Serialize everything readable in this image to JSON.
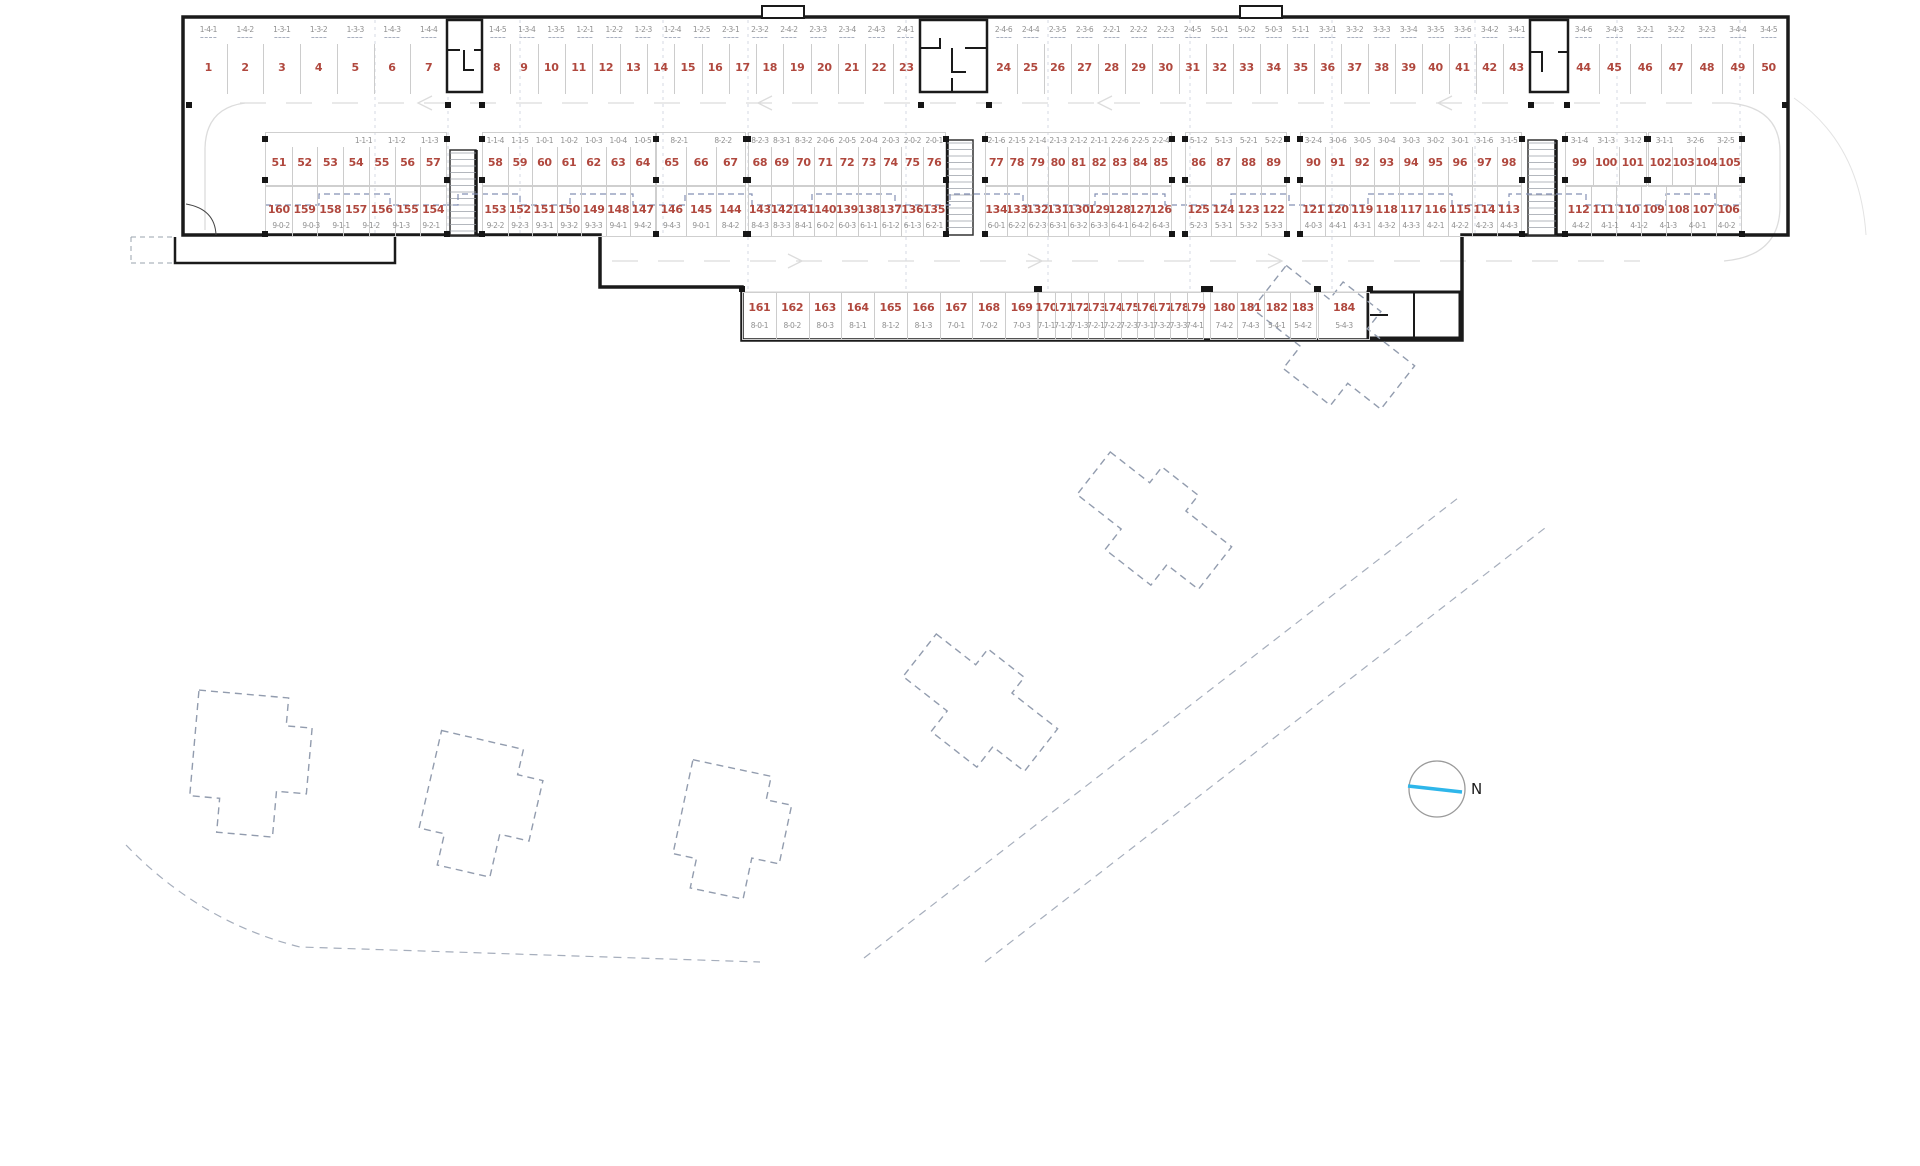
{
  "plan": {
    "type": "parking-garage-floor-plan",
    "north_label": "N",
    "colors": {
      "space_number": "#b0483e",
      "unit_code": "#8f8f8f",
      "wall": "#1a1a1a",
      "dashed_outline": "#929cae",
      "partition_dash": "#8490b4",
      "aisle_marking": "#dcdcdc",
      "north_arrow": "#2eb6ea"
    },
    "rows": [
      {
        "name": "row-1-top",
        "codes_position": "above",
        "groups": [
          {
            "numbers": [
              1,
              2,
              3,
              4,
              5,
              6,
              7
            ],
            "codes": [
              "1-4-1",
              "1-4-2",
              "1-3-1",
              "1-3-2",
              "1-3-3",
              "1-4-3",
              "1-4-4"
            ]
          },
          {
            "numbers": [
              8,
              9,
              10,
              11,
              12,
              13,
              14,
              15,
              16,
              17,
              18,
              19,
              20,
              21,
              22,
              23
            ],
            "codes": [
              "1-4-5",
              "1-3-4",
              "1-3-5",
              "1-2-1",
              "1-2-2",
              "1-2-3",
              "1-2-4",
              "1-2-5",
              "2-3-1",
              "2-3-2",
              "2-4-2",
              "2-3-3",
              "2-3-4",
              "2-4-3",
              "2-4-1"
            ]
          },
          {
            "numbers": [
              24,
              25,
              26,
              27,
              28,
              29,
              30,
              31,
              32,
              33,
              34,
              35,
              36,
              37,
              38,
              39,
              40,
              41,
              42,
              43
            ],
            "codes": [
              "2-4-6",
              "2-4-4",
              "2-3-5",
              "2-3-6",
              "2-2-1",
              "2-2-2",
              "2-2-3",
              "2-4-5",
              "5-0-1",
              "5-0-2",
              "5-0-3",
              "5-1-1",
              "3-3-1",
              "3-3-2",
              "3-3-3",
              "3-3-4",
              "3-3-5",
              "3-3-6",
              "3-4-2",
              "3-4-1"
            ]
          },
          {
            "numbers": [
              44,
              45,
              46,
              47,
              48,
              49,
              50
            ],
            "codes": [
              "3-4-6",
              "3-4-3",
              "3-2-1",
              "3-2-2",
              "3-2-3",
              "3-4-4",
              "3-4-5"
            ]
          }
        ]
      },
      {
        "name": "row-2",
        "codes_position": "above",
        "groups": [
          {
            "numbers": [
              51,
              52,
              53,
              54,
              55,
              56,
              57
            ],
            "codes": [
              "1-1-1",
              "1-1-2",
              "1-1-3"
            ]
          },
          {
            "numbers": [
              58,
              59,
              60,
              61,
              62,
              63,
              64
            ],
            "codes": [
              "1-1-4",
              "1-1-5",
              "1-0-1",
              "1-0-2",
              "1-0-3",
              "1-0-4",
              "1-0-5"
            ]
          },
          {
            "numbers": [
              65,
              66,
              67
            ],
            "codes": [
              "8-2-1",
              "8-2-2"
            ]
          },
          {
            "numbers": [
              68,
              69,
              70,
              71,
              72,
              73,
              74,
              75,
              76
            ],
            "codes": [
              "8-2-3",
              "8-3-1",
              "8-3-2",
              "2-0-6",
              "2-0-5",
              "2-0-4",
              "2-0-3",
              "2-0-2",
              "2-0-1"
            ]
          },
          {
            "numbers": [
              77,
              78,
              79,
              80,
              81,
              82,
              83,
              84,
              85
            ],
            "codes": [
              "2-1-6",
              "2-1-5",
              "2-1-4",
              "2-1-3",
              "2-1-2",
              "2-1-1",
              "2-2-6",
              "2-2-5",
              "2-2-4"
            ]
          },
          {
            "numbers": [
              86,
              87,
              88,
              89
            ],
            "codes": [
              "5-1-2",
              "5-1-3",
              "5-2-1",
              "5-2-2"
            ]
          },
          {
            "numbers": [
              90,
              91,
              92,
              93,
              94,
              95,
              96,
              97,
              98
            ],
            "codes": [
              "3-2-4",
              "3-0-6",
              "3-0-5",
              "3-0-4",
              "3-0-3",
              "3-0-2",
              "3-0-1",
              "3-1-6",
              "3-1-5"
            ]
          },
          {
            "numbers": [
              99,
              100,
              101
            ],
            "codes": [
              "3-1-4",
              "3-1-3",
              "3-1-2"
            ]
          },
          {
            "numbers": [
              102,
              103,
              104,
              105
            ],
            "codes": [
              "3-1-1",
              "3-2-6",
              "3-2-5"
            ]
          }
        ]
      },
      {
        "name": "row-3",
        "codes_position": "below",
        "groups": [
          {
            "numbers": [
              160,
              159,
              158,
              157,
              156,
              155,
              154
            ],
            "codes": [
              "9-0-2",
              "9-0-3",
              "9-1-1",
              "9-1-2",
              "9-1-3",
              "9-2-1"
            ]
          },
          {
            "numbers": [
              153,
              152,
              151,
              150,
              149,
              148,
              147
            ],
            "codes": [
              "9-2-2",
              "9-2-3",
              "9-3-1",
              "9-3-2",
              "9-3-3",
              "9-4-1",
              "9-4-2"
            ]
          },
          {
            "numbers": [
              146,
              145,
              144
            ],
            "codes": [
              "9-4-3",
              "9-0-1",
              "8-4-2"
            ]
          },
          {
            "numbers": [
              143,
              142,
              141,
              140,
              139,
              138,
              137,
              136,
              135
            ],
            "codes": [
              "8-4-3",
              "8-3-3",
              "8-4-1",
              "6-0-2",
              "6-0-3",
              "6-1-1",
              "6-1-2",
              "6-1-3",
              "6-2-1"
            ]
          },
          {
            "numbers": [
              134,
              133,
              132,
              131,
              130,
              129,
              128,
              127,
              126
            ],
            "codes": [
              "6-0-1",
              "6-2-2",
              "6-2-3",
              "6-3-1",
              "6-3-2",
              "6-3-3",
              "6-4-1",
              "6-4-2",
              "6-4-3"
            ]
          },
          {
            "numbers": [
              125,
              124,
              123,
              122
            ],
            "codes": [
              "5-2-3",
              "5-3-1",
              "5-3-2",
              "5-3-3"
            ]
          },
          {
            "numbers": [
              121,
              120,
              119,
              118,
              117,
              116,
              115,
              114,
              113
            ],
            "codes": [
              "4-0-3",
              "4-4-1",
              "4-3-1",
              "4-3-2",
              "4-3-3",
              "4-2-1",
              "4-2-2",
              "4-2-3",
              "4-4-3"
            ]
          },
          {
            "numbers": [
              112,
              111,
              110,
              109,
              108,
              107,
              106
            ],
            "codes": [
              "4-4-2",
              "4-1-1",
              "4-1-2",
              "4-1-3",
              "4-0-1",
              "4-0-2"
            ]
          }
        ]
      },
      {
        "name": "row-4-bottom",
        "codes_position": "below",
        "groups": [
          {
            "numbers": [
              161,
              162,
              163,
              164,
              165,
              166,
              167,
              168,
              169
            ],
            "codes": [
              "8-0-1",
              "8-0-2",
              "8-0-3",
              "8-1-1",
              "8-1-2",
              "8-1-3",
              "7-0-1",
              "7-0-2",
              "7-0-3"
            ]
          },
          {
            "numbers": [
              170,
              171,
              172,
              173,
              174,
              175,
              176,
              177,
              178,
              179
            ],
            "codes": [
              "7-1-1",
              "7-1-2",
              "7-1-3",
              "7-2-1",
              "7-2-2",
              "7-2-3",
              "7-3-1",
              "7-3-2",
              "7-3-3",
              "7-4-1"
            ]
          },
          {
            "numbers": [
              180,
              181,
              182,
              183
            ],
            "codes": [
              "7-4-2",
              "7-4-3",
              "5-4-1",
              "5-4-2"
            ]
          },
          {
            "numbers": [
              184
            ],
            "codes": [
              "5-4-3"
            ]
          }
        ]
      }
    ]
  }
}
